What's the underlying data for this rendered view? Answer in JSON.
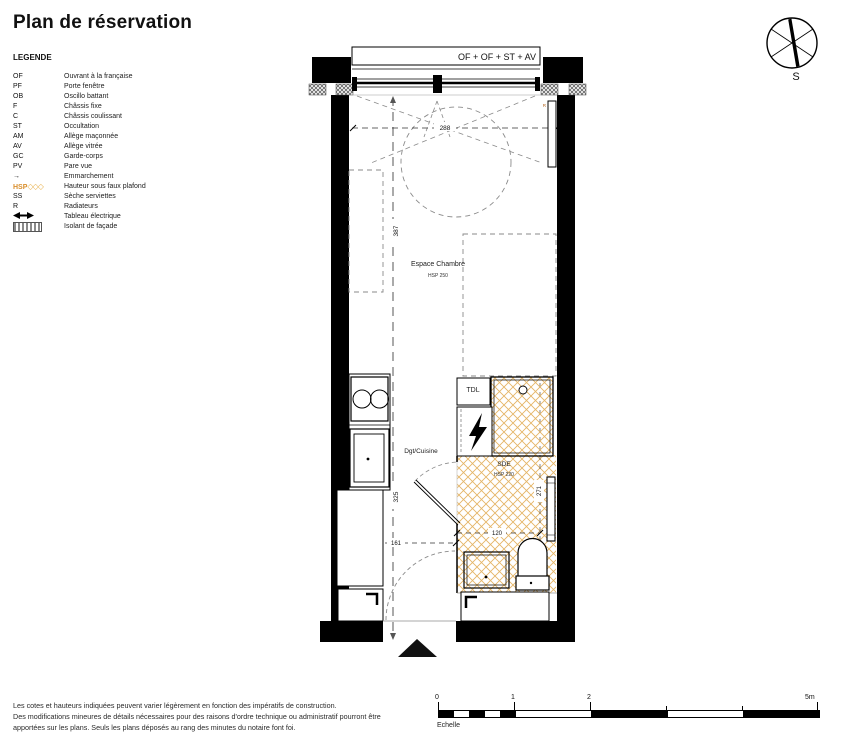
{
  "title": "Plan de réservation",
  "legend": {
    "heading": "LEGENDE",
    "items": [
      {
        "symbol": "OF",
        "label": "Ouvrant à la française"
      },
      {
        "symbol": "PF",
        "label": "Porte fenêtre"
      },
      {
        "symbol": "OB",
        "label": "Oscillo battant"
      },
      {
        "symbol": "F",
        "label": "Châssis fixe"
      },
      {
        "symbol": "C",
        "label": "Châssis coulissant"
      },
      {
        "symbol": "ST",
        "label": "Occultation"
      },
      {
        "symbol": "AM",
        "label": "Allège maçonnée"
      },
      {
        "symbol": "AV",
        "label": "Allège vitrée"
      },
      {
        "symbol": "GC",
        "label": "Garde-corps"
      },
      {
        "symbol": "PV",
        "label": "Pare vue"
      },
      {
        "symbol": "→",
        "label": "Emmarchement"
      },
      {
        "symbol": "HSP",
        "diamonds": "◇◇◇",
        "label": "Hauteur sous faux plafond"
      },
      {
        "symbol": "SS",
        "label": "Sèche serviettes"
      },
      {
        "symbol": "R",
        "label": "Radiateurs"
      },
      {
        "symbol": "",
        "label": "Tableau électrique",
        "icon": "electric-panel"
      },
      {
        "symbol": "",
        "label": "Isolant de façade",
        "icon": "facade-insulation"
      }
    ]
  },
  "compass": {
    "south_label": "S"
  },
  "plan": {
    "window_label": "OF + OF + ST + AV",
    "chambre_name": "Espace Chambre",
    "chambre_hsp": "HSP 250",
    "cuisine_label": "Dgt/Cuisine",
    "sde_name": "SDE",
    "sde_hsp": "HSP 220",
    "tdl_label": "TDL",
    "radiator_label": "R",
    "dims": {
      "room_width": "288",
      "room_length": "387",
      "kitchen_length": "325",
      "sde_length": "271",
      "sde_width": "120",
      "entry_width": "161"
    }
  },
  "scalebar": {
    "t0": "0",
    "t1": "1",
    "t2": "2",
    "t5": "5m",
    "caption": "Echelle"
  },
  "footer": {
    "line1": "Les cotes et hauteurs indiquées peuvent varier légèrement en fonction des impératifs de construction.",
    "line2": "Des modifications mineures de détails nécessaires pour des raisons d'ordre technique ou administratif pourront être",
    "line3": "apportées sur les plans. Seuls les plans déposés au rang des minutes du notaire font foi."
  },
  "colors": {
    "hsp_hatch": "#E4B566",
    "accent_orange": "#D98E2B",
    "wall": "#000000"
  }
}
